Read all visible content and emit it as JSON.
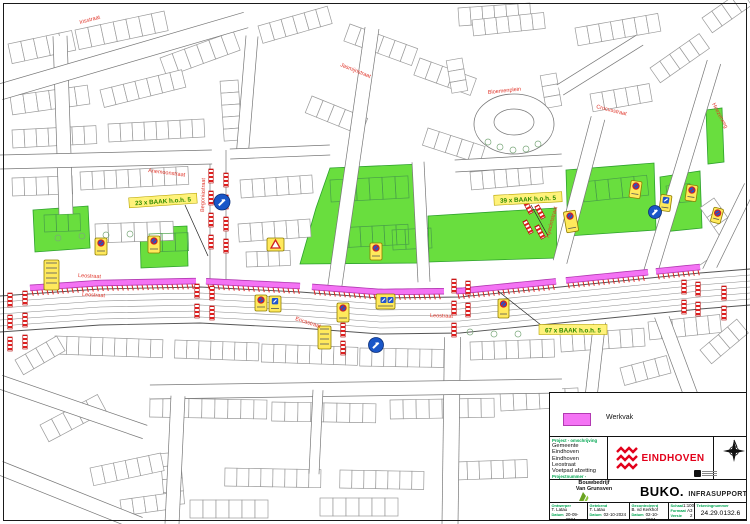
{
  "legend": {
    "werkvak": "Werkvak"
  },
  "map": {
    "street_names": [
      {
        "text": "Leostraat",
        "x": 78,
        "y": 277,
        "rot": 3
      },
      {
        "text": "Leostraat",
        "x": 82,
        "y": 296,
        "rot": 3
      },
      {
        "text": "Leostraat",
        "x": 430,
        "y": 317,
        "rot": 2
      },
      {
        "text": "Anemoonstraat",
        "x": 148,
        "y": 172,
        "rot": 7
      },
      {
        "text": "Irisstraat",
        "x": 80,
        "y": 24,
        "rot": -15
      },
      {
        "text": "Jasmijnstraat",
        "x": 340,
        "y": 66,
        "rot": 22
      },
      {
        "text": "Ericastraat",
        "x": 295,
        "y": 320,
        "rot": 18
      },
      {
        "text": "Bloemenplein",
        "x": 488,
        "y": 94,
        "rot": -6
      },
      {
        "text": "Crocusstraat",
        "x": 596,
        "y": 108,
        "rot": 14
      },
      {
        "text": "Heezerweg",
        "x": 712,
        "y": 104,
        "rot": 62
      },
      {
        "text": "Begoniastraat",
        "x": 204,
        "y": 212,
        "rot": -88
      },
      {
        "text": "Hyacintstraat",
        "x": 549,
        "y": 238,
        "rot": -75
      }
    ],
    "baak_labels": [
      {
        "text": "23 x BAAK h.o.h. 5",
        "x": 163,
        "y": 201,
        "rot": -4
      },
      {
        "text": "39 x BAAK h.o.h. 5",
        "x": 528,
        "y": 199,
        "rot": -3
      },
      {
        "text": "67 x BAAK h.o.h. 5",
        "x": 573,
        "y": 330,
        "rot": 0
      }
    ],
    "symbols": [
      "werkvak-strip",
      "baak-barrier",
      "no-parking-sign",
      "direction-sign",
      "warning-sign",
      "text-sign"
    ]
  },
  "title_block": {
    "project_label": "Project - omschrijving",
    "project_lines": [
      "Gemeente Eindhoven",
      "Eindhoven",
      "Leostraat",
      "Voetpad afzetting"
    ],
    "projectnummer_label": "Projectnummer -",
    "projectnummer": "24.29.0132",
    "municipality_logo": "EINDHOVEN",
    "contractor_line1": "Bouwbedrijf",
    "contractor_line2": "Van Grunsven",
    "brand_name": "BUKO.",
    "brand_suffix": "INFRASUPPORT",
    "fields": {
      "ontwerper_label": "Ontwerper",
      "ontwerper": "T. Latau",
      "ontwerper_datum": "20-09-2024",
      "getekend_label": "Getekend",
      "getekend": "T. Latau",
      "getekend_datum": "02-10-2024",
      "gecontroleerd_label": "Gecontroleerd",
      "gecontroleerd": "B. vd Kerkhof",
      "gecontroleerd_datum": "02-10-2024",
      "datum_label": "Datum",
      "schaal_label": "Schaal",
      "schaal": "1:1000",
      "formaat_label": "Formaat",
      "formaat": "A3",
      "versie_label": "Versie",
      "versie": "2",
      "tekeningnummer_label": "Tekeningnummer",
      "tekeningnummer": "24.29.0132.6"
    }
  },
  "colors": {
    "werkvak": "#f473f4",
    "werkvak_border": "#b23ab2",
    "green_area": "#69de3e",
    "green_border": "#2da02d",
    "barrier_red": "#e02020",
    "sign_yellow": "#ffe95c",
    "street_label_red": "#e0352a",
    "baak_green": "#2f8a00",
    "eindhoven_red": "#e2001a"
  }
}
